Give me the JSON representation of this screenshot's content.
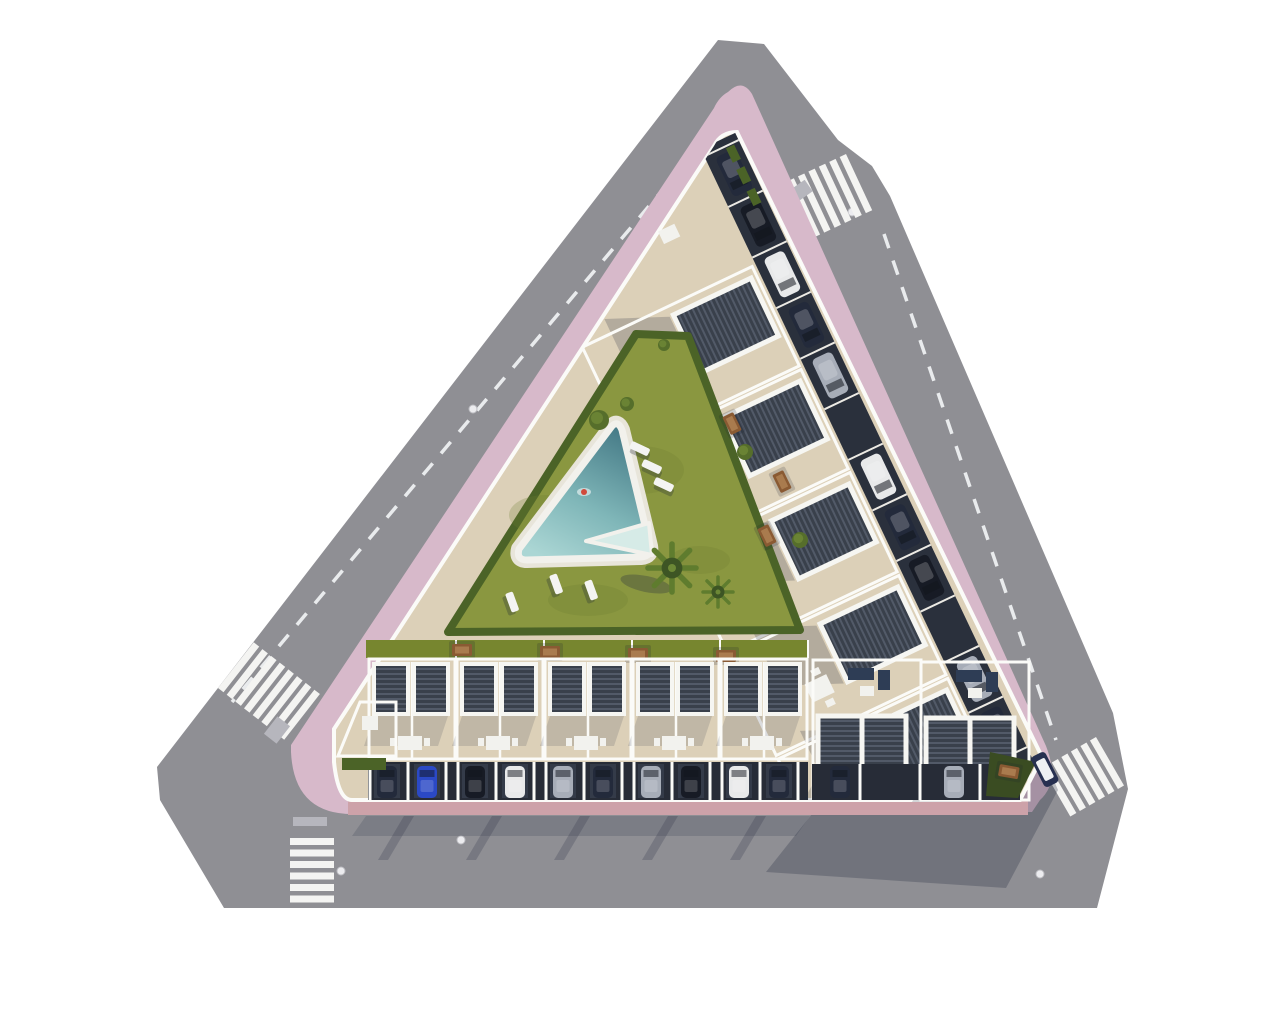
{
  "scene": {
    "kind": "aerial-3d-site-plan-render",
    "subject": "Triangular residential block with central lawn and triangular pool, perimeter streets, zebra crossings, rooftop pergola terraces and perimeter parking",
    "canvas_width": 1280,
    "canvas_height": 1024,
    "background": "#ffffff"
  },
  "palette": {
    "road": "#8f8f94",
    "road_marking": "#eef0f1",
    "sidewalk_pink": "#d7b9ca",
    "paver_salmon": "#cda2a9",
    "lawn": "#8a9740",
    "hedge": "#4b6327",
    "garden_strip": "#77862f",
    "corner_garden": "#3a4c22",
    "pool_deep": "#477c88",
    "pool_mid": "#7fb6b8",
    "pool_shallow": "#abd6d4",
    "pool_steps": "#d6ebe7",
    "pool_deck": "#f2f1ec",
    "terrace": "#dcd0b8",
    "wall_white": "#fbfbf8",
    "pergola_slat_base": "#39404b",
    "pergola_slat_line": "#525a68",
    "pergola_frame": "#f6f6f2",
    "facade_dark": "#272c37",
    "parking_bay": "#2a303c",
    "table_wood": "#8a5a33",
    "palm_green": "#47612a",
    "shadow_rgba": "rgba(35,41,60,0.30)",
    "car_navy": "#232a3b",
    "car_black": "#171b25",
    "car_white": "#e8e9ea",
    "car_silver": "#a7adb8",
    "car_blue": "#2b49c6",
    "swimmer_red": "#d04a3c"
  },
  "features": {
    "streets": {
      "count": 3,
      "sides": [
        "northwest",
        "east",
        "south"
      ]
    },
    "crosswalks": {
      "count": 4,
      "positions": [
        "north-apex",
        "west-corner",
        "south",
        "southeast-corner"
      ],
      "stripe_counts": [
        7,
        8,
        6,
        6
      ]
    },
    "manholes": {
      "count": 5
    },
    "sidewalk": {
      "shape": "rounded-triangle",
      "material": "pink pavers"
    },
    "pool": {
      "shape": "triangular",
      "swimmer": true,
      "loungers": 6
    },
    "garden": {
      "palm_trees": 2,
      "bushes": 5,
      "dining_tables": 7,
      "lawn": true
    },
    "housing": {
      "right_wing_pergola_units": 5,
      "south_row_houses": 5,
      "south_large_units": 2,
      "west_tip_terrace": 1
    },
    "vehicles": {
      "perimeter_parking_bays": 12,
      "perimeter_parked_cars": 10,
      "south_garage_cars": 12,
      "street_van": 1
    }
  }
}
